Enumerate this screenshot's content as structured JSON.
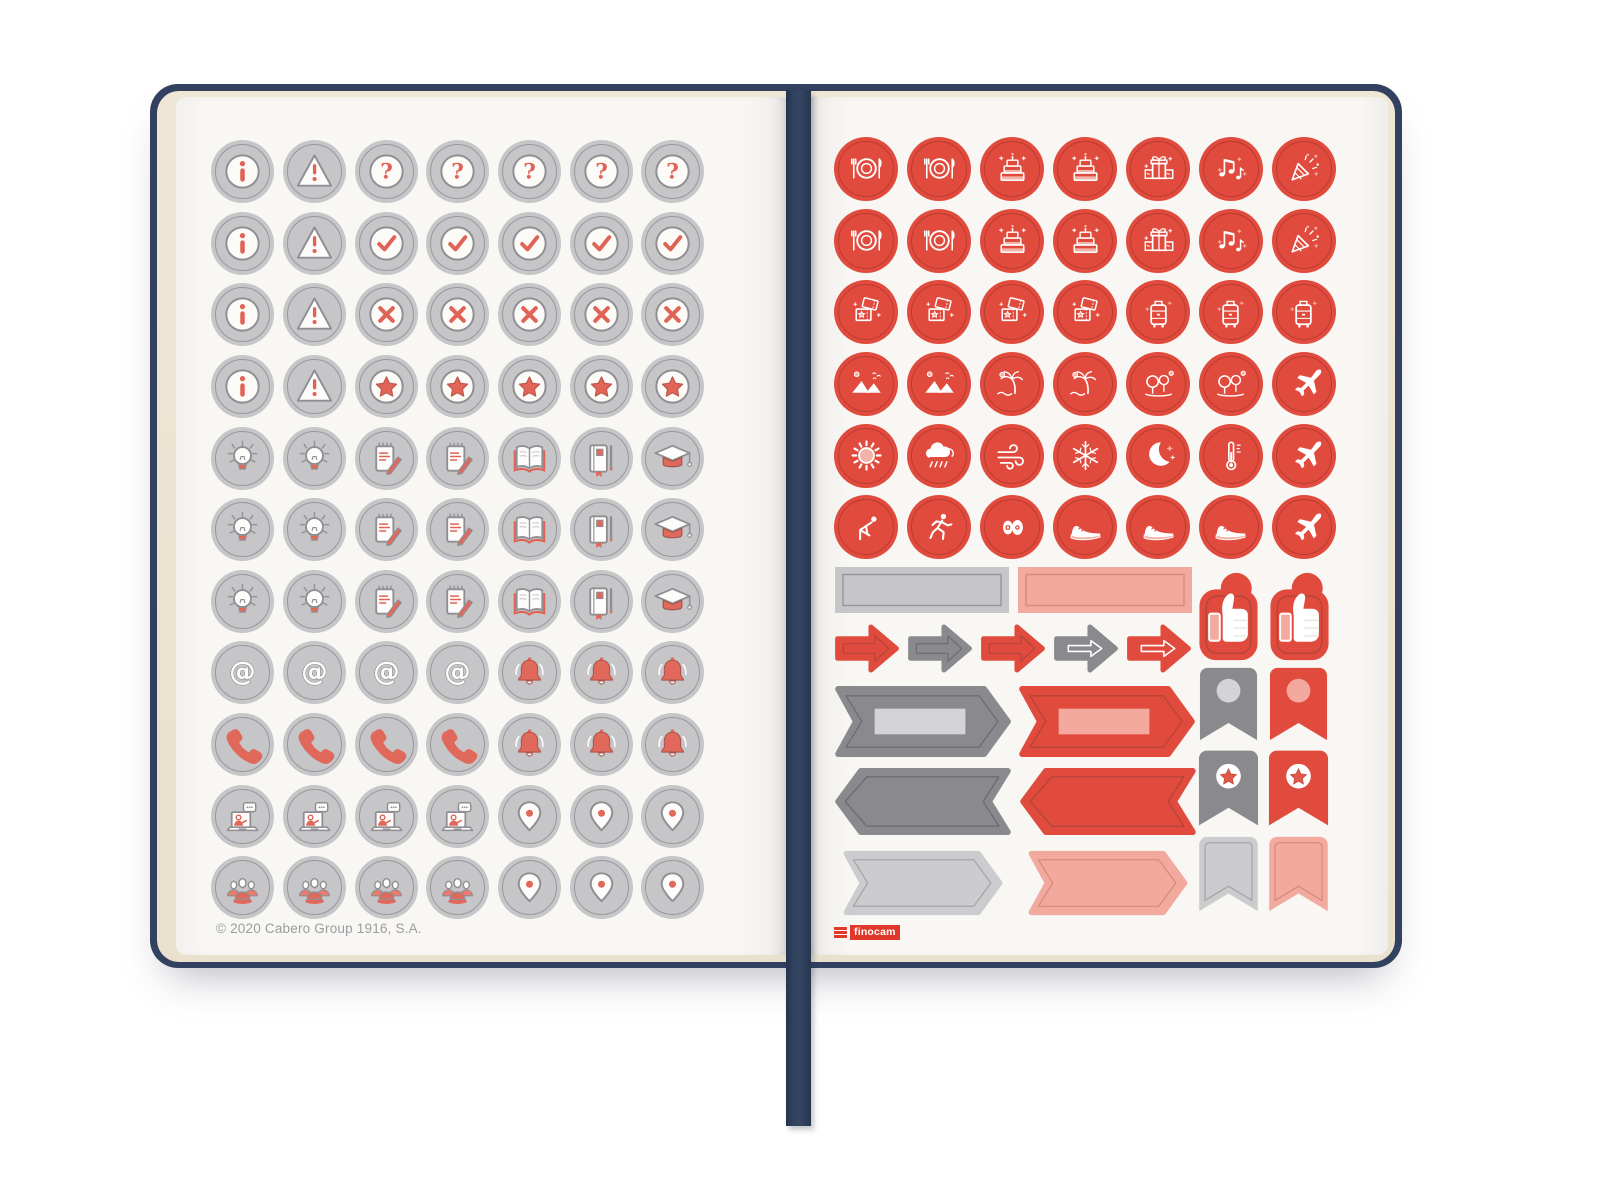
{
  "product": {
    "type": "planner sticker sheets",
    "copyright": "© 2020 Cabero Group 1916, S.A.",
    "brand": "finocam"
  },
  "colors": {
    "sticker_red": "#e14b3e",
    "sticker_gray": "#c6c5c8",
    "icon_accent_red": "#df6356",
    "banner_dark_gray": "#8a898d",
    "banner_light_gray": "#cccbcd",
    "salmon": "#f2a99e",
    "cover_navy": "#31415f",
    "ribbon_navy": "#2c3c59",
    "page_white": "#f8f6f2",
    "page_edge_cream": "#ebe2d0"
  },
  "left_page": {
    "sticker_rows": [
      [
        "info",
        "warning",
        "question",
        "question",
        "question",
        "question",
        "question"
      ],
      [
        "info",
        "warning",
        "check",
        "check",
        "check",
        "check",
        "check"
      ],
      [
        "info",
        "warning",
        "cross",
        "cross",
        "cross",
        "cross",
        "cross"
      ],
      [
        "info",
        "warning",
        "star",
        "star",
        "star",
        "star",
        "star"
      ],
      [
        "bulb",
        "bulb",
        "notepad",
        "notepad",
        "book",
        "notebook",
        "gradcap"
      ],
      [
        "bulb",
        "bulb",
        "notepad",
        "notepad",
        "book",
        "notebook",
        "gradcap"
      ],
      [
        "bulb",
        "bulb",
        "notepad",
        "notepad",
        "book",
        "notebook",
        "gradcap"
      ],
      [
        "at",
        "at",
        "at",
        "at",
        "bell",
        "bell",
        "bell"
      ],
      [
        "phone",
        "phone",
        "phone",
        "phone",
        "bell",
        "bell",
        "bell"
      ],
      [
        "laptop",
        "laptop",
        "laptop",
        "laptop",
        "pin",
        "pin",
        "pin"
      ],
      [
        "people",
        "people",
        "people",
        "people",
        "pin",
        "pin",
        "pin"
      ]
    ]
  },
  "right_page": {
    "brand": "finocam",
    "sticker_rows": [
      [
        "plate",
        "plate",
        "cake",
        "cake",
        "gift",
        "music",
        "party"
      ],
      [
        "plate",
        "plate",
        "cake",
        "cake",
        "gift",
        "music",
        "party"
      ],
      [
        "tickets",
        "tickets",
        "tickets",
        "tickets",
        "luggage",
        "luggage",
        "luggage"
      ],
      [
        "mountains",
        "mountains",
        "beach",
        "beach",
        "trees",
        "trees",
        "plane"
      ],
      [
        "sun",
        "rain",
        "wind",
        "snowflake",
        "moon",
        "thermometer",
        "plane"
      ],
      [
        "yoga",
        "run",
        "weights",
        "sneaker",
        "sneaker",
        "sneaker",
        "plane"
      ]
    ],
    "sticker_shapes": {
      "labels": [
        {
          "kind": "label",
          "variant": "gray"
        },
        {
          "kind": "label",
          "variant": "salmon"
        }
      ],
      "arrows": [
        {
          "kind": "arrow",
          "variant": "red"
        },
        {
          "kind": "arrow",
          "variant": "darkgray"
        },
        {
          "kind": "arrow",
          "variant": "red"
        },
        {
          "kind": "arrow-glyph",
          "variant": "darkgray"
        },
        {
          "kind": "arrow-glyph",
          "variant": "red"
        }
      ],
      "banners_right": [
        {
          "kind": "banner-right",
          "variant": "darkgray"
        },
        {
          "kind": "banner-right",
          "variant": "red"
        }
      ],
      "banners_left": [
        {
          "kind": "banner-left",
          "variant": "darkgray"
        },
        {
          "kind": "banner-left",
          "variant": "red"
        }
      ],
      "banners_light": [
        {
          "kind": "banner-light",
          "variant": "lightgray"
        },
        {
          "kind": "banner-light",
          "variant": "salmon"
        }
      ],
      "thumbs": [
        {
          "kind": "thumb",
          "variant": "red"
        },
        {
          "kind": "thumb",
          "variant": "red"
        }
      ],
      "flags_circle": [
        {
          "kind": "flag-circle",
          "variant": "darkgray"
        },
        {
          "kind": "flag-circle",
          "variant": "red"
        }
      ],
      "flags_star": [
        {
          "kind": "flag-star",
          "variant": "darkgray"
        },
        {
          "kind": "flag-star",
          "variant": "red"
        }
      ],
      "flags_plain": [
        {
          "kind": "flag",
          "variant": "lightgray"
        },
        {
          "kind": "flag",
          "variant": "salmon"
        }
      ]
    }
  }
}
